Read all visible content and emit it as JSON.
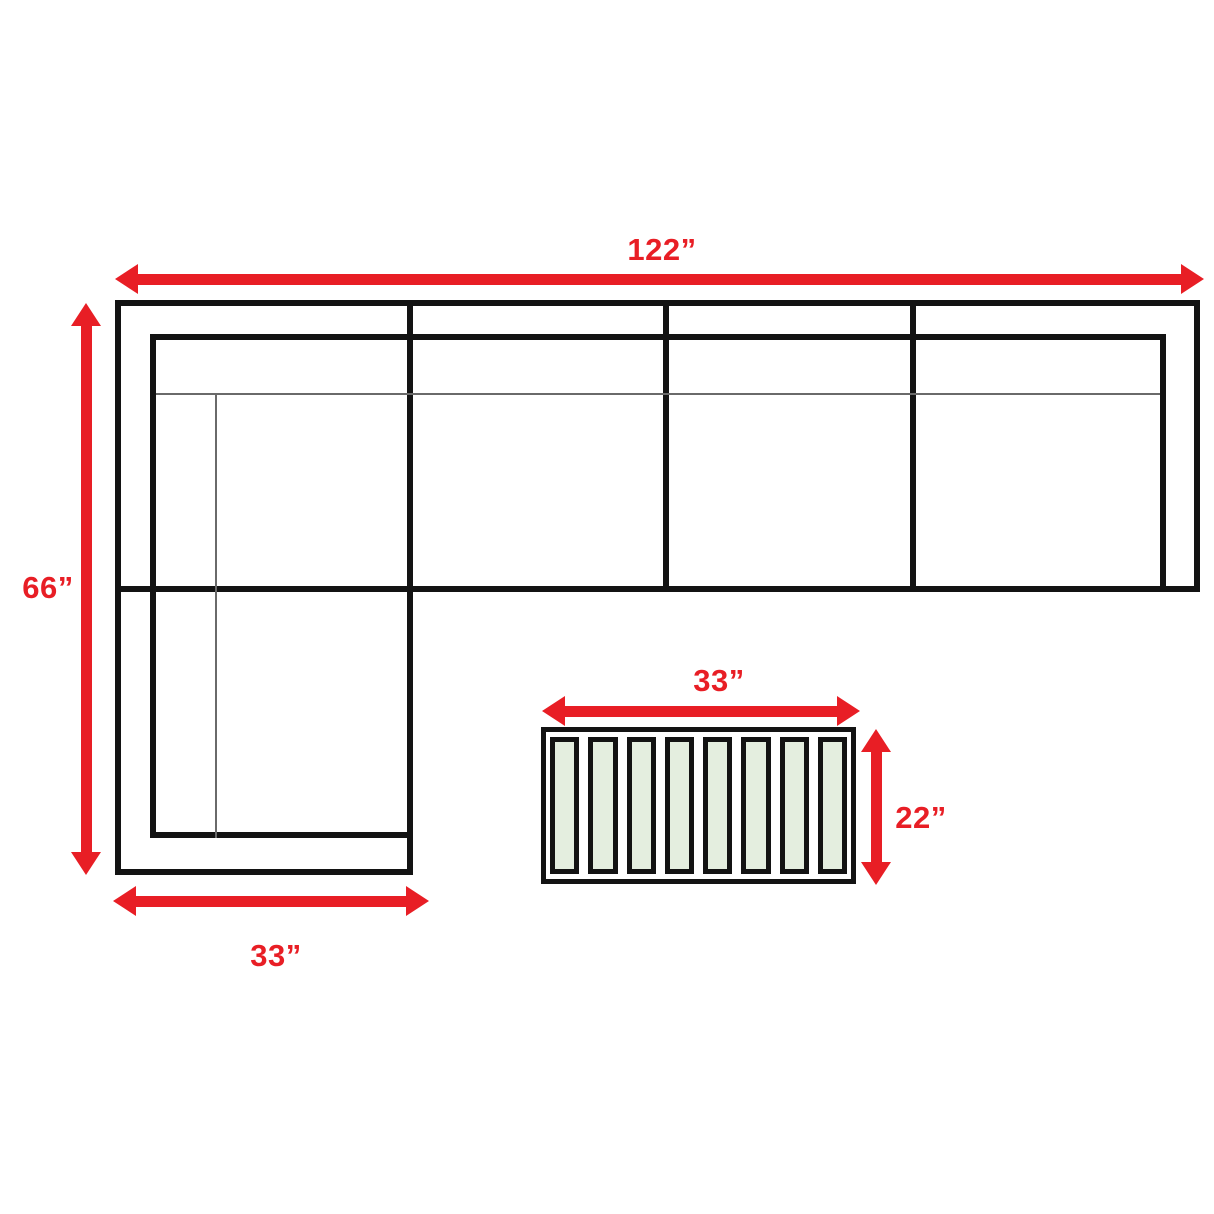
{
  "diagram": {
    "type": "sectional-sofa-floorplan-with-coffee-table",
    "sofa": {
      "overall_width_label": "122”",
      "overall_depth_label": "66”",
      "chaise_width_label": "33”",
      "seat_sections": 4
    },
    "coffee_table": {
      "width_label": "33”",
      "depth_label": "22”",
      "slat_count": 8
    }
  },
  "colors": {
    "accent_red": "#e81e25",
    "line_black": "#131313",
    "thin_line": "#6a6a6a",
    "slat_fill": "#e4eedf",
    "background": "#ffffff"
  }
}
